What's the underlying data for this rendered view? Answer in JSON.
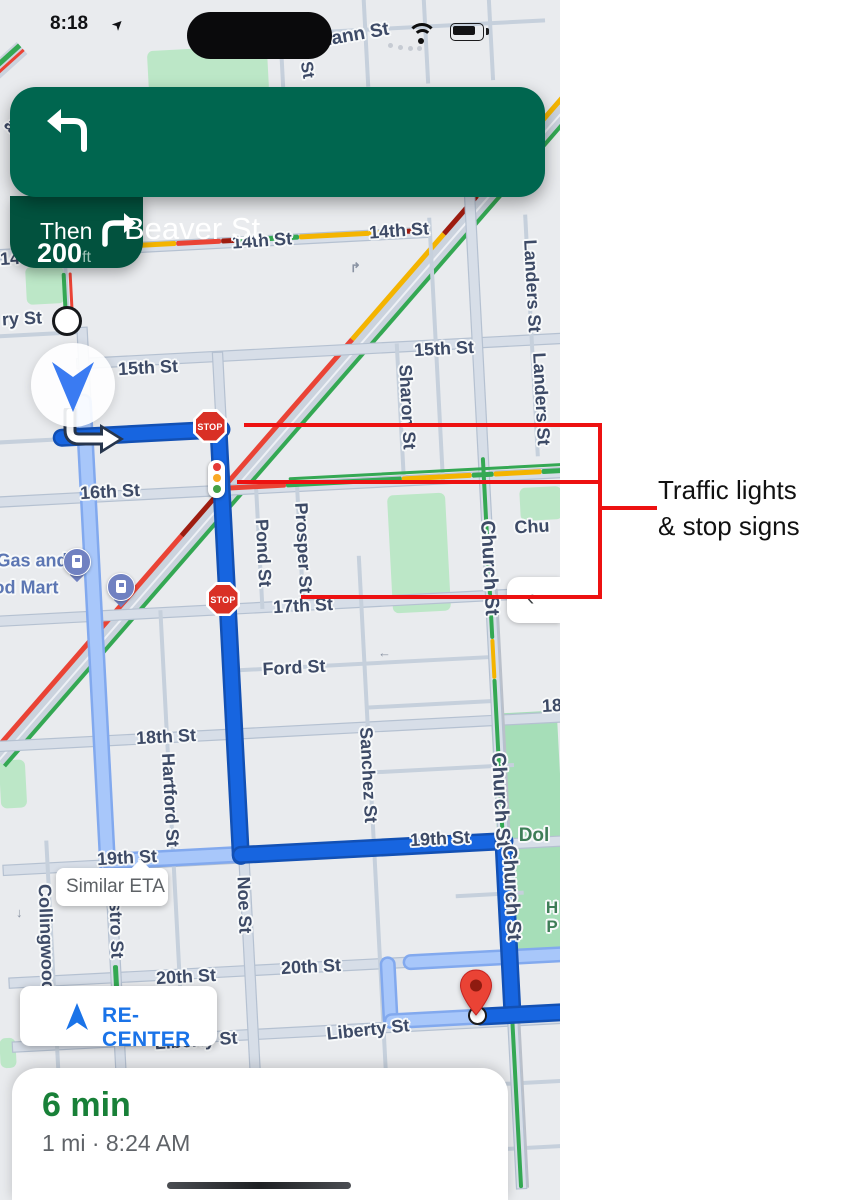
{
  "status_bar": {
    "time": "8:18"
  },
  "nav_banner": {
    "distance": "200",
    "unit": "ft",
    "street": "Beaver St",
    "then_label": "Then",
    "bg": "#00664F",
    "then_bg": "#02523E"
  },
  "similar_eta": {
    "label": "Similar ETA"
  },
  "recenter": {
    "label": "RE-CENTER",
    "color": "#1A73E8"
  },
  "eta_card": {
    "duration": "6 min",
    "details": "1 mi · 8:24 AM",
    "duration_color": "#188038"
  },
  "annotation": {
    "line1": "Traffic lights",
    "line2": "& stop signs",
    "color": "#ED1111"
  },
  "map": {
    "bg": "#E9EBEE",
    "colors": {
      "minor": "#C6D0DC",
      "major_fill": "#D7DEE8",
      "major_edge": "#B5C1D1",
      "park": "#BCE7C7",
      "dpark": "#A6DEB8",
      "label": "#3D4A66",
      "gas_label": "#5C76B3",
      "park_label": "#3E7D57",
      "green": "#34A853",
      "yellow": "#F4B400",
      "red": "#EA4335",
      "dred": "#9E1C10",
      "route": "#1765E0",
      "route_casing": "#1250B4",
      "alt": "#A8C7FA",
      "alt_casing": "#82A9EE",
      "rail": "#BAC0CA",
      "market_fill": "#CBD3DE",
      "dash": "#EDF0F5"
    },
    "stop_text": "STOP",
    "stop_signs": [
      {
        "x": 193,
        "y": 409
      },
      {
        "x": 206,
        "y": 582
      }
    ],
    "traffic_light_dots": [
      "#E53935",
      "#F9A825",
      "#43A047"
    ],
    "gas_pins": [
      {
        "x": 63,
        "y": 548
      },
      {
        "x": 107,
        "y": 573
      }
    ],
    "one_way_arrows": [
      {
        "x": 378,
        "y": 645,
        "g": "←"
      },
      {
        "x": 16,
        "y": 905,
        "g": "↓"
      },
      {
        "x": 350,
        "y": 260,
        "g": "↱"
      }
    ],
    "leader_dots": [
      {
        "x": 388,
        "y": 43
      },
      {
        "x": 398,
        "y": 45
      },
      {
        "x": 408,
        "y": 46
      },
      {
        "x": 417,
        "y": 46
      }
    ],
    "parks": [
      {
        "x": 148,
        "y": 48,
        "w": 120,
        "h": 47
      },
      {
        "x": 26,
        "y": 266,
        "w": 38,
        "h": 38
      },
      {
        "x": 390,
        "y": 494,
        "w": 58,
        "h": 118
      },
      {
        "x": 520,
        "y": 487,
        "w": 42,
        "h": 33
      },
      {
        "x": 497,
        "y": 712,
        "w": 66,
        "h": 240,
        "c": "d"
      },
      {
        "x": 0,
        "y": 760,
        "w": 26,
        "h": 48
      },
      {
        "x": 0,
        "y": 1038,
        "w": 16,
        "h": 30
      }
    ],
    "h_streets": [
      {
        "y": 35,
        "x1": 320,
        "x2": 575,
        "k": "min"
      },
      {
        "y": 240,
        "x1": -5,
        "x2": 448,
        "k": "maj"
      },
      {
        "y": 322,
        "x1": -10,
        "x2": 98,
        "k": "min"
      },
      {
        "y": 353,
        "x1": 90,
        "x2": 575,
        "k": "maj"
      },
      {
        "y": 428,
        "x1": -10,
        "x2": 232,
        "k": "min"
      },
      {
        "y": 487,
        "x1": -10,
        "x2": 575,
        "k": "maj"
      },
      {
        "y": 606,
        "x1": -10,
        "x2": 575,
        "k": "maj"
      },
      {
        "y": 668,
        "x1": 230,
        "x2": 492,
        "k": "min"
      },
      {
        "y": 712,
        "x1": 361,
        "x2": 490,
        "k": "min"
      },
      {
        "y": 731,
        "x1": -10,
        "x2": 575,
        "k": "maj"
      },
      {
        "y": 777,
        "x1": 361,
        "x2": 505,
        "k": "min"
      },
      {
        "y": 855,
        "x1": -10,
        "x2": 575,
        "k": "maj"
      },
      {
        "y": 905,
        "x1": 440,
        "x2": 508,
        "k": "min"
      },
      {
        "y": 968,
        "x1": -10,
        "x2": 575,
        "k": "maj"
      },
      {
        "y": 1032,
        "x1": -10,
        "x2": 575,
        "k": "maj"
      },
      {
        "y": 1095,
        "x1": 350,
        "x2": 575,
        "k": "min"
      },
      {
        "y": 1160,
        "x1": 350,
        "x2": 575,
        "k": "min"
      }
    ],
    "v_streets": [
      {
        "x": 34,
        "y1": 828,
        "y2": 1110,
        "k": "min"
      },
      {
        "x": 96,
        "y1": 318,
        "y2": 1200,
        "k": "maj"
      },
      {
        "x": 83,
        "y1": 235,
        "y2": 325,
        "k": "min"
      },
      {
        "x": 160,
        "y1": 604,
        "y2": 1034,
        "k": "min"
      },
      {
        "x": 230,
        "y1": 350,
        "y2": 1200,
        "k": "maj"
      },
      {
        "x": 262,
        "y1": 485,
        "y2": 608,
        "k": "min"
      },
      {
        "x": 303,
        "y1": 485,
        "y2": 608,
        "k": "min"
      },
      {
        "x": 361,
        "y1": 560,
        "y2": 1200,
        "k": "min"
      },
      {
        "x": 410,
        "y1": 350,
        "y2": 489,
        "k": "min"
      },
      {
        "x": 449,
        "y1": 226,
        "y2": 489,
        "k": "min"
      },
      {
        "x": 490,
        "y1": 195,
        "y2": 1200,
        "k": "maj"
      },
      {
        "x": 545,
        "y1": 228,
        "y2": 470,
        "k": "min"
      },
      {
        "x": 310,
        "y1": 30,
        "y2": 92,
        "k": "min"
      },
      {
        "x": 395,
        "y1": -5,
        "y2": 92,
        "k": "min"
      },
      {
        "x": 455,
        "y1": -5,
        "y2": 92,
        "k": "min"
      },
      {
        "x": 520,
        "y1": -5,
        "y2": 92,
        "k": "min"
      }
    ],
    "traffic_h": [
      {
        "y": 238,
        "x1": 125,
        "x2": 195,
        "c": "yellow"
      },
      {
        "y": 238,
        "x1": 195,
        "x2": 240,
        "c": "red"
      },
      {
        "y": 238,
        "x1": 240,
        "x2": 258,
        "c": "dred"
      },
      {
        "y": 238,
        "x1": 258,
        "x2": 318,
        "c": "green"
      },
      {
        "y": 238,
        "x1": 318,
        "x2": 425,
        "c": "yellow"
      },
      {
        "y": 238,
        "x1": 425,
        "x2": 448,
        "c": "dred"
      },
      {
        "y": 485,
        "x1": 222,
        "x2": 292,
        "c": "red"
      },
      {
        "y": 485,
        "x1": 292,
        "x2": 408,
        "c": "green"
      },
      {
        "y": 485,
        "x1": 408,
        "x2": 478,
        "c": "yellow"
      },
      {
        "y": 485,
        "x1": 478,
        "x2": 500,
        "c": "green"
      },
      {
        "y": 485,
        "x1": 500,
        "x2": 548,
        "c": "yellow"
      },
      {
        "y": 485,
        "x1": 548,
        "x2": 575,
        "c": "green"
      },
      {
        "y": 479,
        "x1": 295,
        "x2": 575,
        "c": "green",
        "w": 3
      }
    ],
    "traffic_v": [
      {
        "x": 81,
        "y1": 262,
        "y2": 322,
        "c": "green",
        "w": 4
      },
      {
        "x": 87,
        "y1": 262,
        "y2": 322,
        "c": "red",
        "w": 3
      },
      {
        "x": 96,
        "y1": 956,
        "y2": 994,
        "c": "green",
        "w": 5
      },
      {
        "x": 490,
        "y1": 468,
        "y2": 650,
        "c": "green",
        "w": 4
      },
      {
        "x": 490,
        "y1": 650,
        "y2": 690,
        "c": "yellow",
        "w": 4
      },
      {
        "x": 490,
        "y1": 690,
        "y2": 1200,
        "c": "green",
        "w": 4
      },
      {
        "x": 497,
        "y1": 600,
        "y2": 1200,
        "c": "rail",
        "w": 2
      }
    ],
    "routes_light": [
      {
        "t": "v",
        "x": 94,
        "y1": 386,
        "y2": 862,
        "w": 12
      },
      {
        "t": "h",
        "y": 852,
        "x1": 90,
        "x2": 238,
        "w": 12
      },
      {
        "t": "h",
        "y": 968,
        "x1": 386,
        "x2": 562,
        "w": 11
      },
      {
        "t": "v",
        "x": 368,
        "y1": 964,
        "y2": 1030,
        "w": 11
      },
      {
        "t": "h",
        "y": 1026,
        "x1": 364,
        "x2": 458,
        "w": 11
      }
    ],
    "routes_dark": [
      {
        "t": "h",
        "y": 426,
        "x1": 64,
        "x2": 237,
        "w": 13
      },
      {
        "t": "v",
        "x": 227,
        "y1": 420,
        "y2": 860,
        "w": 13
      },
      {
        "t": "h",
        "y": 852,
        "x1": 221,
        "x2": 498,
        "w": 13
      },
      {
        "t": "v",
        "x": 490,
        "y1": 846,
        "y2": 1032,
        "w": 13
      },
      {
        "t": "h",
        "y": 1026,
        "x1": 452,
        "x2": 575,
        "w": 13
      }
    ],
    "market": {
      "x": 575,
      "y": 85,
      "len": 880,
      "angle": 131,
      "width": 22,
      "bottom_stripes": [
        {
          "a": 0,
          "b": 140,
          "c": "yellow"
        },
        {
          "a": 140,
          "b": 190,
          "c": "dred"
        },
        {
          "a": 190,
          "b": 330,
          "c": "yellow"
        },
        {
          "a": 330,
          "b": 540,
          "c": "red"
        },
        {
          "a": 540,
          "b": 590,
          "c": "dred"
        },
        {
          "a": 590,
          "b": 880,
          "c": "red"
        }
      ]
    },
    "corner_road": {
      "x": 14,
      "y": 48,
      "len": 130,
      "angle": 48
    },
    "street_labels": [
      {
        "t": "mann St",
        "x": 352,
        "y": 36,
        "r": -10,
        "s": 19
      },
      {
        "t": "St",
        "x": 307,
        "y": 70,
        "r": 80,
        "s": 17
      },
      {
        "t": "astro",
        "x": 22,
        "y": 138,
        "r": 48,
        "s": 18
      },
      {
        "t": "14",
        "x": 10,
        "y": 259,
        "r": -4
      },
      {
        "t": "14th St",
        "x": 262,
        "y": 241,
        "r": -4
      },
      {
        "t": "14th St",
        "x": 399,
        "y": 231,
        "r": -4
      },
      {
        "t": "ry St",
        "x": 22,
        "y": 319,
        "r": -3
      },
      {
        "t": "15th St",
        "x": 148,
        "y": 368,
        "r": -3
      },
      {
        "t": "15th St",
        "x": 444,
        "y": 349,
        "r": -3
      },
      {
        "t": "Sharon St",
        "x": 407,
        "y": 407,
        "r": 87
      },
      {
        "t": "Landers St",
        "x": 532,
        "y": 286,
        "r": 87
      },
      {
        "t": "Landers St",
        "x": 541,
        "y": 399,
        "r": 87
      },
      {
        "t": "16th St",
        "x": 110,
        "y": 492,
        "r": -3
      },
      {
        "t": "Gas and",
        "x": 32,
        "y": 561,
        "r": 0,
        "c": "gas"
      },
      {
        "t": "od Mart",
        "x": 26,
        "y": 588,
        "r": 0,
        "c": "gas"
      },
      {
        "t": "Pond St",
        "x": 263,
        "y": 553,
        "r": 87
      },
      {
        "t": "Prosper St",
        "x": 303,
        "y": 548,
        "r": 87
      },
      {
        "t": "Chu",
        "x": 532,
        "y": 527,
        "r": -3
      },
      {
        "t": "Church St",
        "x": 489,
        "y": 568,
        "r": 87,
        "s": 20
      },
      {
        "t": "17th St",
        "x": 303,
        "y": 606,
        "r": -3
      },
      {
        "t": "Ford St",
        "x": 294,
        "y": 668,
        "r": -3
      },
      {
        "t": "18th St",
        "x": 166,
        "y": 737,
        "r": -3
      },
      {
        "t": "18",
        "x": 552,
        "y": 706,
        "r": -3
      },
      {
        "t": "Hartford St",
        "x": 170,
        "y": 800,
        "r": 87
      },
      {
        "t": "Sanchez St",
        "x": 368,
        "y": 775,
        "r": 87
      },
      {
        "t": "Church St",
        "x": 500,
        "y": 800,
        "r": 87,
        "s": 20
      },
      {
        "t": "Church St",
        "x": 511,
        "y": 893,
        "r": 87,
        "s": 20
      },
      {
        "t": "Dol",
        "x": 534,
        "y": 836,
        "r": 0,
        "c": "park",
        "s": 19
      },
      {
        "t": "19th St",
        "x": 127,
        "y": 858,
        "r": -3
      },
      {
        "t": "19th St",
        "x": 440,
        "y": 839,
        "r": -3
      },
      {
        "t": "Collingwood",
        "x": 46,
        "y": 938,
        "r": 88
      },
      {
        "t": "stro St",
        "x": 116,
        "y": 930,
        "r": 88
      },
      {
        "t": "Noe St",
        "x": 244,
        "y": 905,
        "r": 88
      },
      {
        "t": "H",
        "x": 552,
        "y": 908,
        "r": 0,
        "c": "park",
        "s": 17
      },
      {
        "t": "P",
        "x": 552,
        "y": 927,
        "r": 0,
        "c": "park",
        "s": 17
      },
      {
        "t": "20th St",
        "x": 186,
        "y": 977,
        "r": -3
      },
      {
        "t": "20th St",
        "x": 311,
        "y": 967,
        "r": -3
      },
      {
        "t": "Liberty St",
        "x": 196,
        "y": 1041,
        "r": -4
      },
      {
        "t": "Liberty St",
        "x": 368,
        "y": 1030,
        "r": -6
      }
    ]
  },
  "red_lines": [
    {
      "x": 244,
      "y": 423,
      "w": 358,
      "h": 4
    },
    {
      "x": 237,
      "y": 480,
      "w": 365,
      "h": 4
    },
    {
      "x": 301,
      "y": 595,
      "w": 301,
      "h": 4
    },
    {
      "x": 598,
      "y": 423,
      "w": 4,
      "h": 176
    },
    {
      "x": 598,
      "y": 506,
      "w": 59,
      "h": 4
    }
  ]
}
